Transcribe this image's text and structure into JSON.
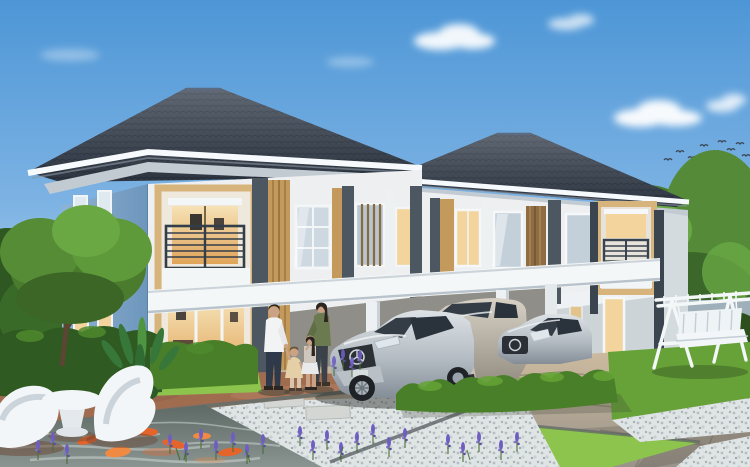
{
  "scene": {
    "setting": "Photorealistic architectural rendering of two modern two-storey detached houses with carports",
    "sky": "Clear blue sky with scattered soft clouds and a small flock of birds at the right",
    "foreground": "Koi pond with orange fish, lavender flower spikes, white sculptural lounge chairs and table on a brown stone deck, white-gravel path with stepping stones, tiled driveway and lawn strips",
    "people": "Family of four (man, woman, two girls) standing between the houses near the cars",
    "vehicles": "Silver sedan and silver SUV under the left carport, silver sedan behind the hedge at the right house",
    "garden": "White A-frame garden swing bench on the right lawn, trimmed hedges, ornamental tree and tropical plant at the left"
  },
  "counts": {
    "houses": 2,
    "cars": 3,
    "people": 4,
    "birds": 9,
    "lounge_chairs": 2,
    "koi_fish": 6,
    "clouds": 5
  },
  "palette": {
    "roof": "#36404f",
    "ridge": "#5b6b82",
    "fascia": "#f7fafc",
    "soffit": "#c2cbd2",
    "wall_cream": "#edeff0",
    "wall_blue": "#82a9cd",
    "wall_gray": "#cdd4d8",
    "side_gray": "#d4dbdf",
    "accent_tan": "#d7b47c",
    "accent_tan_deep": "#c49a5c",
    "trim_dark": "#4c5762",
    "glow_warm": "#f2d49c",
    "glow_deep": "#e0a95c",
    "glass_cool": "#c3d0da",
    "railing": "#39434e",
    "beam_white": "#f4f7f8",
    "carport_shade": "#8f8e88",
    "hedge_dark": "#2f5a21",
    "hedge_mid": "#497f28",
    "hedge_light": "#65a436",
    "grass": "#74ad3d",
    "grass_light": "#8cc44e",
    "gravel": "#dfe4e5",
    "paving_joint": "#77705f",
    "deck": "#a06c50",
    "pond": "#6b7673",
    "ripple": "#d3dbd8",
    "koi_orange": "#e4652c",
    "lavender": "#6f5ec2",
    "stem_green": "#4b6e3a",
    "car_glass": "#343c46",
    "furniture_white": "#f3f6f8",
    "skin": "#caa286",
    "shirt_white": "#f2f3f4",
    "pants_navy": "#2e3a4a",
    "top_olive": "#6b7a4f",
    "dress_beige": "#e4cfa6",
    "hair_dark": "#2b241f",
    "bird": "#3c4856",
    "tree_green": "#4b7c2e",
    "fence_gray": "#9fb0ba"
  }
}
